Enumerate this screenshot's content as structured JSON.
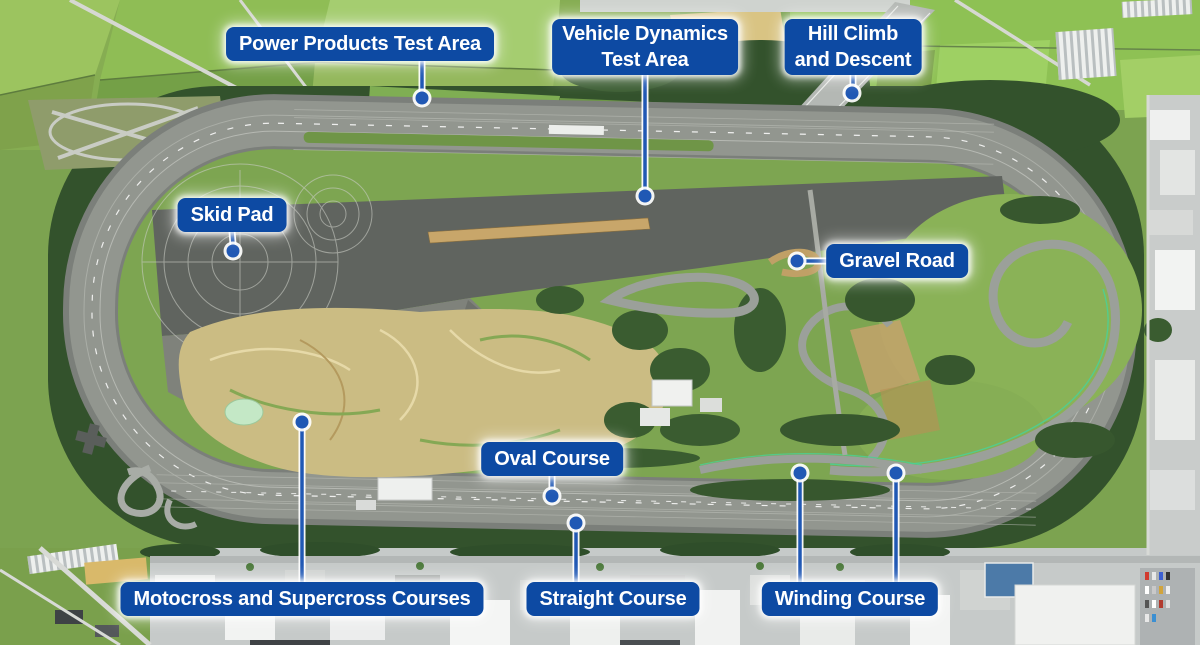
{
  "map": {
    "type": "annotated-aerial-map",
    "subject": "automotive proving ground with banked oval track, test courses and surrounding farmland and town"
  },
  "colors": {
    "badge_bg": "#0d4aa3",
    "badge_text": "#ffffff",
    "leader_line": "#2058b4",
    "leader_casing": "#ffffff"
  },
  "labels": [
    {
      "id": "power-products-test-area",
      "text": "Power Products Test Area"
    },
    {
      "id": "vehicle-dynamics-test-area",
      "text": "Vehicle Dynamics\nTest Area"
    },
    {
      "id": "hill-climb-and-descent",
      "text": "Hill Climb\nand Descent"
    },
    {
      "id": "skid-pad",
      "text": "Skid Pad"
    },
    {
      "id": "gravel-road",
      "text": "Gravel Road"
    },
    {
      "id": "oval-course",
      "text": "Oval Course"
    },
    {
      "id": "motocross-and-supercross-courses",
      "text": "Motocross and Supercross Courses"
    },
    {
      "id": "straight-course",
      "text": "Straight Course"
    },
    {
      "id": "winding-course",
      "text": "Winding Course"
    }
  ]
}
